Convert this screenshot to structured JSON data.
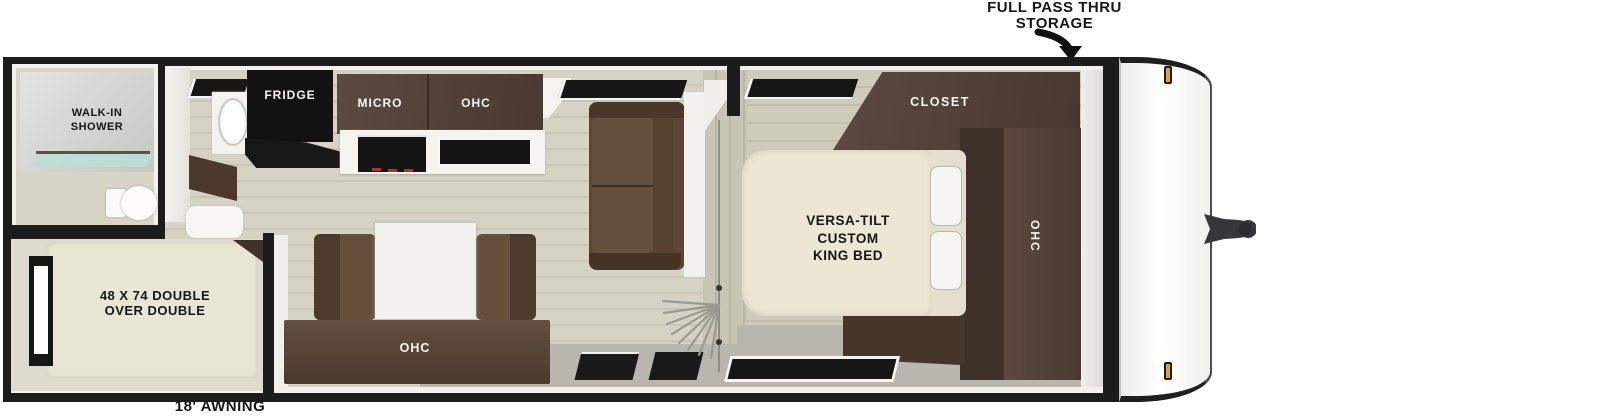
{
  "colors": {
    "wall": "#1c1c1c",
    "cabinet": "#4e3c32",
    "cabinet_dark": "#41322a",
    "sofa": "#5b4635",
    "bench": "#66503c",
    "bed": "#ece7d4",
    "table": "#f2f1ee",
    "floor": "#d5d1c3",
    "floor_bedroom": "#cdc9b8",
    "walkway": "#b8b6ae",
    "shower_glass": "#b9ded8",
    "marker_light": "#d9a23c",
    "appliance_black": "#141414"
  },
  "annotations": {
    "pass_thru": "FULL PASS THRU\nSTORAGE",
    "awning": "18' AWNING"
  },
  "rooms": {
    "bathroom": {
      "shower": "WALK-IN\nSHOWER"
    },
    "bunk_room": {
      "bed": "48 X 74 DOUBLE\nOVER DOUBLE"
    },
    "kitchen": {
      "fridge": "FRIDGE",
      "micro": "MICRO",
      "ohc": "OHC"
    },
    "dinette": {
      "ohc": "OHC"
    },
    "bedroom": {
      "closet": "CLOSET",
      "bed": "VERSA-TILT\nCUSTOM\nKING BED",
      "ohc": "OHC"
    }
  }
}
